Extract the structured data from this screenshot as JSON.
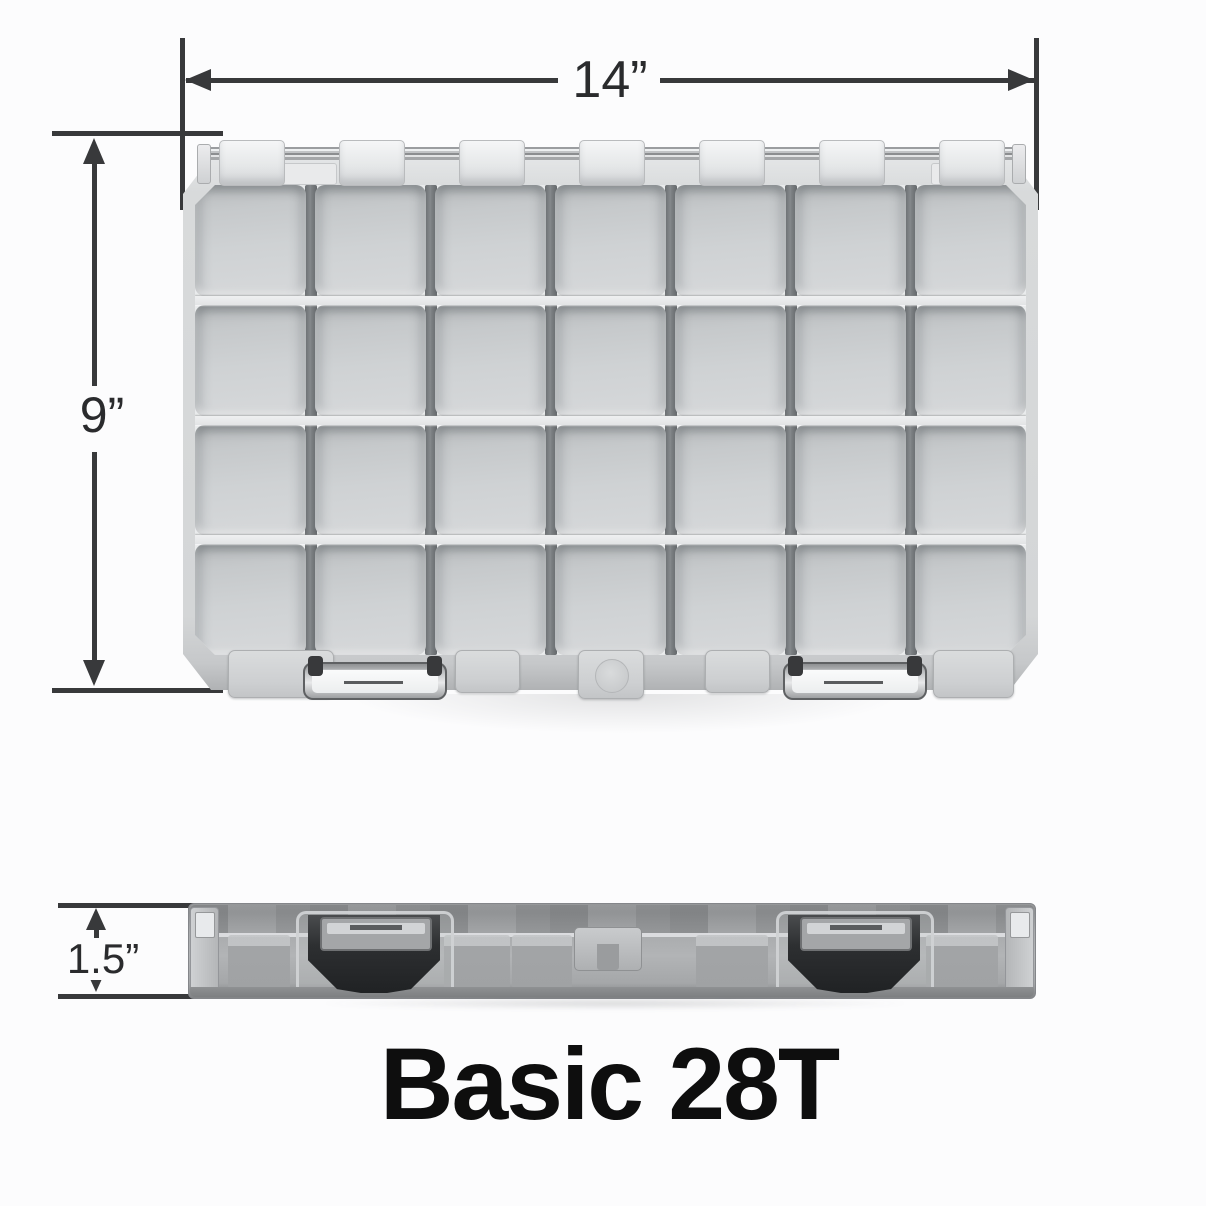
{
  "title": {
    "text": "Basic 28T",
    "color": "#0e0e0e"
  },
  "dimensions": {
    "width": {
      "label": "14”",
      "value_inches": 14
    },
    "depth": {
      "label": "9”",
      "value_inches": 9
    },
    "height": {
      "label": "1.5”",
      "value_inches": 1.5
    }
  },
  "product": {
    "name": "Basic 28T",
    "grid": {
      "rows": 4,
      "columns": 7,
      "compartments": 28
    },
    "hinge_knuckles": 7,
    "top_view_latches": 2,
    "side_view_latches": 2
  },
  "colors": {
    "dimension_line": "#38393b",
    "label_text": "#2a2b2d",
    "shell": "#d5d7d8",
    "compartment": "#cbced0",
    "divider_dark": "#75797c",
    "divider_light": "#e9ebec",
    "latch_black": "#2d2f31",
    "metal": "#c7c9cb"
  }
}
